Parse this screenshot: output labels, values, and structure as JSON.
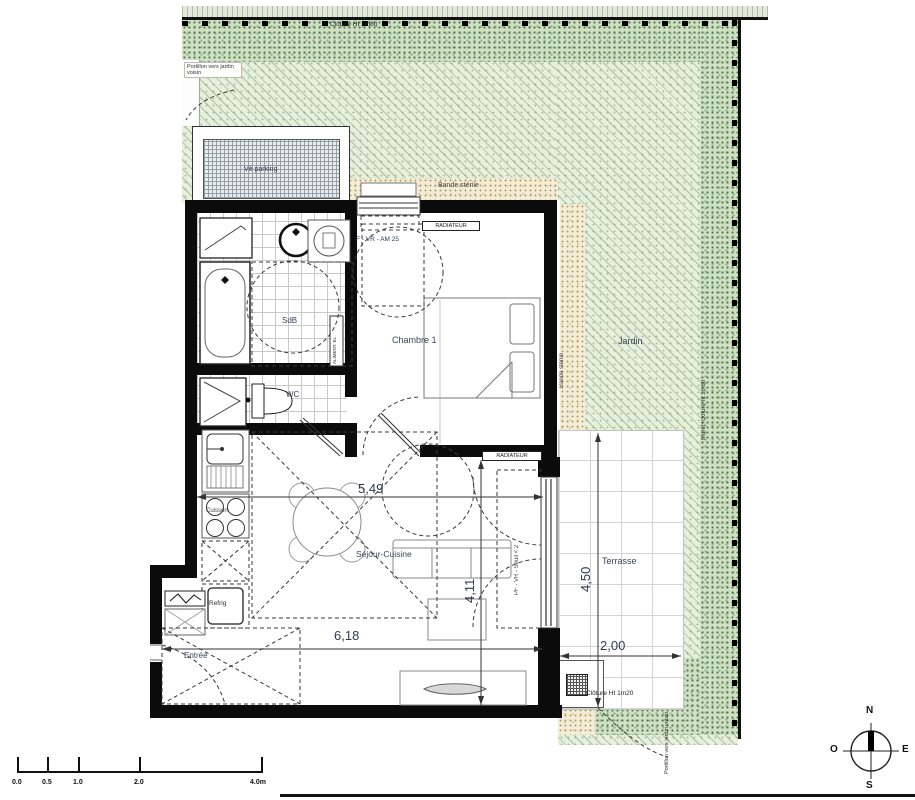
{
  "site": {
    "fence_top_label": "Clôture Ht 1m80",
    "fence_bottom_label": "Clôture Ht 1m20",
    "wall_right_label": "Muret+clôture ht 1m80",
    "gate_top_label": "Portillon vers jardin voisin",
    "gate_bottom_label": "Portillon vers jardin voisin",
    "garden_label": "Jardin",
    "sterile_h_label": "Bande stérile",
    "sterile_v_label": "Bande stérile",
    "bike_parking_label": "Vé parking",
    "terrace_label": "Terrasse"
  },
  "rooms": {
    "bedroom": "Chambre 1",
    "bathroom": "SdB",
    "wc": "WC",
    "living_kitchen": "Séjour-Cuisine",
    "entry": "Entrée"
  },
  "fixtures": {
    "fridge": "Refrig",
    "hob": "Cuisson"
  },
  "equipment": {
    "radiator_bedroom": "RADIATEUR",
    "radiator_living": "RADIATEUR",
    "window_bedroom": "F - VR - AM 25",
    "french_door": "PF - VR - Seuil < 2",
    "duct": "ALIMENT. EL"
  },
  "dimensions": {
    "living_width": "5,49",
    "living_depth": "4,11",
    "entry_width": "6,18",
    "terrace_depth": "4,50",
    "terrace_width": "2,00"
  },
  "scale_bar": {
    "ticks": [
      "0.0",
      "0.5",
      "1.0",
      "2.0",
      "4.0m"
    ]
  },
  "compass": {
    "north": "N",
    "south": "S",
    "east": "E",
    "west": "O"
  },
  "colors": {
    "garden_light": "#e7efdd",
    "garden_dense": "#cfe0c3",
    "sterile_strip": "#f3edd8",
    "ink": "#39455a",
    "wall": "#0b0b0b"
  }
}
